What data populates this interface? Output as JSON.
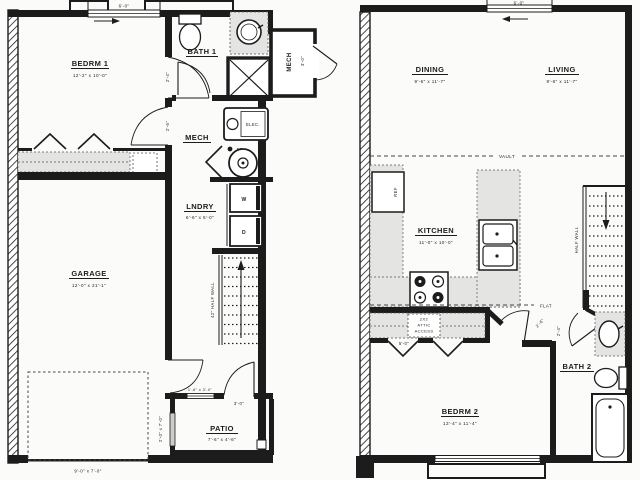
{
  "drawing": {
    "title": "two-level townhome floor plan",
    "ink": "#1c1c1c",
    "counter_fill": "#e4e4e2",
    "paper": "#fbfbfa"
  },
  "floor1": {
    "bedrm1_name": "BEDRM 1",
    "bedrm1_dims": "12'-2\" x 10'-0\"",
    "bath1_name": "BATH 1",
    "mech_upper_name": "MECH",
    "mech_upper_door_dim": "3'-0\"",
    "mech_name": "MECH",
    "lndry_name": "LNDRY",
    "lndry_dims": "6'-6\" x 5'-0\"",
    "garage_name": "GARAGE",
    "garage_dims": "12'-0\" x 21'-1\"",
    "patio_name": "PATIO",
    "patio_dims": "7'-6\" x 4'-6\"",
    "window_top_dim": "6'-0\"",
    "bedrm_door_dim": "2'-4\"",
    "hall_door_dim": "2'-6\"",
    "half_wall_label": "42\" HALF WALL",
    "garage_door_dim": "9'-0\" x 7'-0\"",
    "patio_door_dim": "3'-0\"",
    "patio_window_dim": "1'-6\" x 3'-0\"",
    "side_window_dim": "2'-0\" x 7'-0\"",
    "elec_label": "ELEC.",
    "fd_label": "FD",
    "washer_label": "W",
    "dryer_label": "D"
  },
  "floor2": {
    "dining_name": "DINING",
    "dining_dims": "9'-6\" x 11'-7\"",
    "living_name": "LIVING",
    "living_dims": "9'-6\" x 11'-7\"",
    "kitchen_name": "KITCHEN",
    "kitchen_dims": "11'-0\" x 10'-0\"",
    "bedrm2_name": "BEDRM 2",
    "bedrm2_dims": "13'-4\" x 11'-4\"",
    "bath2_name": "BATH 2",
    "window_top_dim": "6'-0\"",
    "vault_label": "VAULT",
    "flat_label": "FLAT",
    "half_wall_label": "HALF WALL",
    "ref_label": "REF",
    "attic_line1": "2X2",
    "attic_line2": "ATTIC",
    "attic_line3": "ACCESS",
    "attic_dim": "5'-0\"",
    "bedrm2_door_dim": "2'-6\"",
    "bath2_door_dim": "2'-4\""
  }
}
